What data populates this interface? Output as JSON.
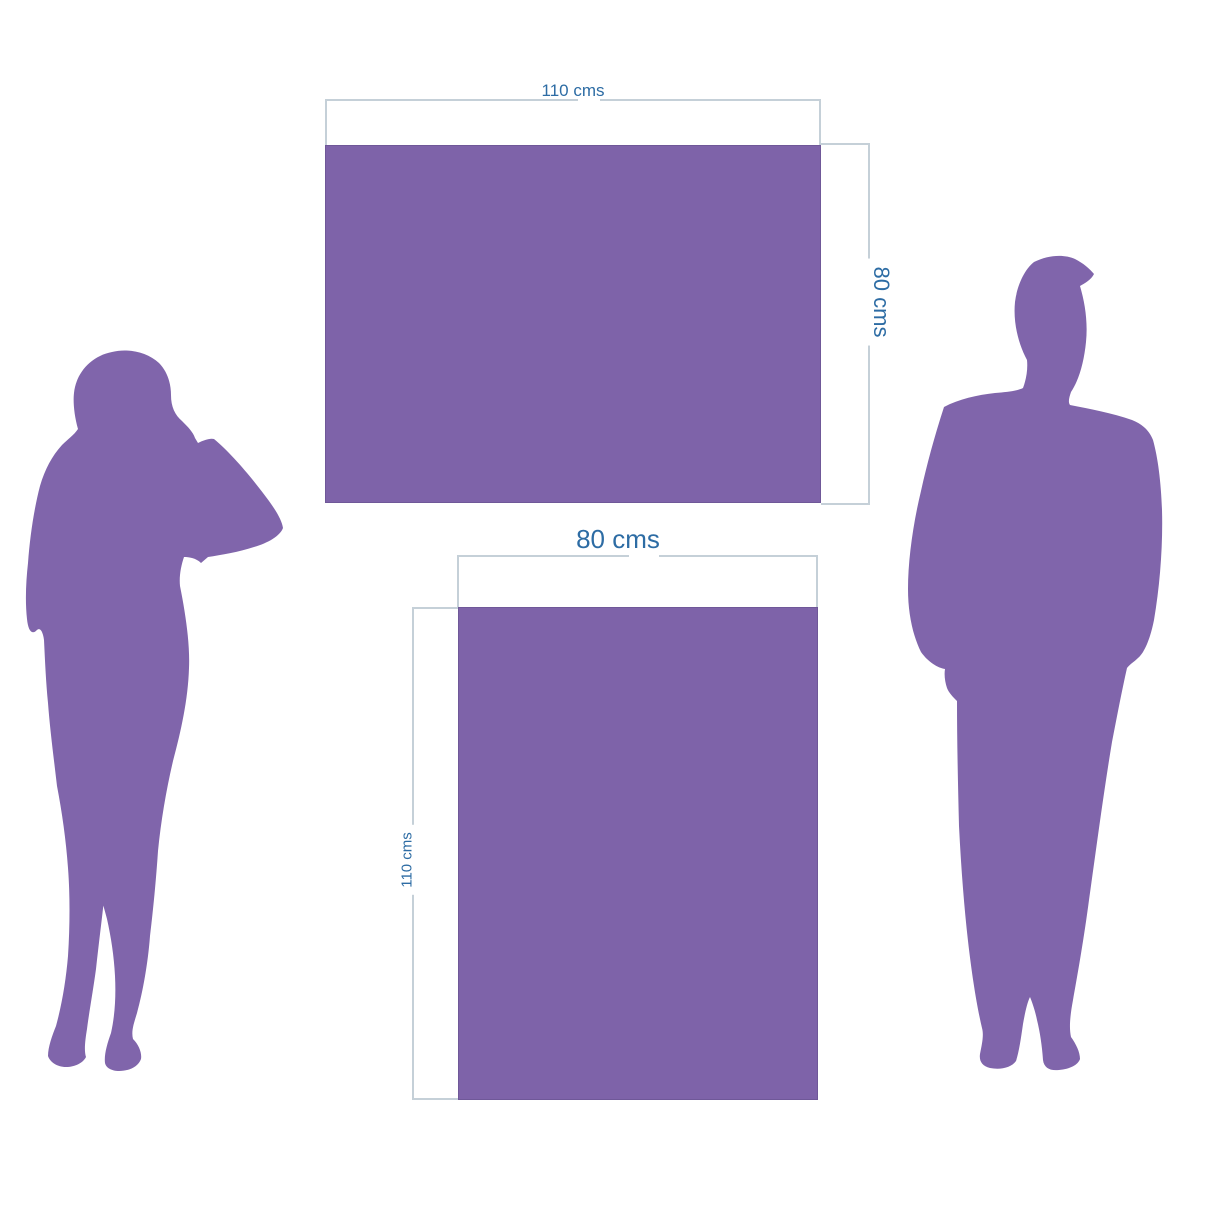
{
  "page": {
    "background": "#ffffff"
  },
  "colors": {
    "artwork_purple": "#7e63a9",
    "artwork_border": "#6f5898",
    "dimension_line": "#c5d0d8",
    "dimension_text": "#2d6ca4",
    "silhouette_purple": "#8065ab",
    "page_bg": "#ffffff"
  },
  "panels": [
    {
      "name": "landscape-artwork",
      "width_label": "110 cms",
      "height_label": "80 cms"
    },
    {
      "name": "portrait-artwork",
      "width_label": "80 cms",
      "height_label": "110 cms"
    }
  ],
  "figures": [
    {
      "name": "woman-silhouette"
    },
    {
      "name": "man-silhouette"
    }
  ]
}
